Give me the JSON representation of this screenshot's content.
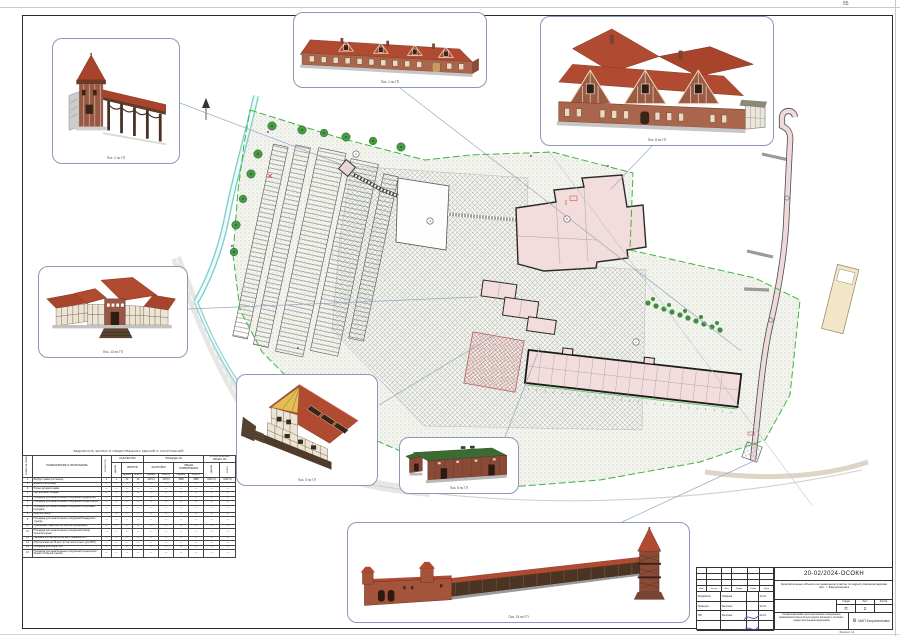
{
  "page": {
    "number": "55",
    "format_note": "Формат А1"
  },
  "colors": {
    "roof_red": "#b04a30",
    "brick": "#a9664d",
    "green_roof": "#3c6a33",
    "stream": "#7fcfcf",
    "boundary_green": "#3db53d",
    "plan_fill_pink": "#f2dcdc",
    "callout_border": "#8a9ab5",
    "signature_blue": "#2b47c4"
  },
  "callouts": [
    {
      "id": "pos2",
      "caption": "Поз. 2 по ГП"
    },
    {
      "id": "pos1",
      "caption": "Поз. 1 по ГП"
    },
    {
      "id": "pos8",
      "caption": "Поз. 8 по ГП"
    },
    {
      "id": "pos13",
      "caption": "Поз. 13 по ГП"
    },
    {
      "id": "pos5",
      "caption": "Поз. 5 по ГП"
    },
    {
      "id": "pos6",
      "caption": "Поз. 6 по ГП"
    },
    {
      "id": "pos15",
      "caption": "Поз. 15 по ГП"
    }
  ],
  "plan_labels": [
    {
      "num": "2"
    },
    {
      "num": "4"
    },
    {
      "num": "8"
    },
    {
      "num": "1"
    }
  ],
  "vedomost": {
    "title": "ВЕДОМОСТЬ ЖИЛЫХ И ОБЩЕСТВЕННЫХ ЗДАНИЙ И СООРУЖЕНИЙ",
    "headers": {
      "col_num": "НОМЕР НА ПЛАНЕ",
      "col_name": "НАИМЕНОВАНИЕ И ОБОЗНАЧЕНИЕ",
      "col_floors": "ЭТАЖНОСТЬ",
      "grp_qty": "КОЛИЧЕСТВО",
      "col_bld": "ЗДАНИЙ",
      "grp_apt": "КВАРТИР",
      "sub_sd": "СДАЕМ",
      "sub_vs": "ВСЕГО",
      "grp_area": "ПЛОЩАДЬ, М2",
      "grp_zastr": "ЗАСТРОЙКИ",
      "grp_obsh": "ОБЩАЯ НОРМИРУЕМАЯ",
      "grp_vol": "СТРОИТЕЛЬНЫЙ ОБЪЕМ, М3",
      "col_vol_bld": "ЗДАНИЙ",
      "col_vol_total": "ВСЕГО"
    },
    "rows": [
      {
        "n": "1",
        "name": "Форбург замка (гостиница)",
        "v": [
          "4",
          "1",
          "42",
          "42",
          "1270,0",
          "1270,0",
          "3985",
          "3985",
          "16017,0",
          "16017,0"
        ]
      },
      {
        "n": "2",
        "name": "Донжон (смотровая)",
        "v": [
          "—",
          "—",
          "—",
          "—",
          "—",
          "—",
          "—",
          "—",
          "—",
          "—"
        ]
      },
      {
        "n": "3",
        "name": "Руины цитадели замка",
        "v": [
          "—",
          "—",
          "—",
          "—",
          "—",
          "—",
          "—",
          "—",
          "—",
          "—"
        ]
      },
      {
        "n": "4",
        "name": "Прогулочная площадь",
        "v": [
          "—",
          "—",
          "—",
          "—",
          "—",
          "—",
          "—",
          "—",
          "—",
          "—"
        ]
      },
      {
        "n": "5",
        "name": "Площадка для некапитальных сооружений (фудкортов)",
        "v": [
          "—",
          "—",
          "—",
          "—",
          "—",
          "—",
          "—",
          "—",
          "—",
          "—"
        ]
      },
      {
        "n": "6",
        "name": "Площадка для некапитальных сооружений летнего музея",
        "v": [
          "—",
          "—",
          "—",
          "—",
          "—",
          "—",
          "—",
          "—",
          "—",
          "—"
        ]
      },
      {
        "n": "7",
        "name": "Площадка для некапитальных сооружений спортивных площадок",
        "v": [
          "—",
          "—",
          "—",
          "—",
          "—",
          "—",
          "—",
          "—",
          "—",
          "—"
        ]
      },
      {
        "n": "8",
        "name": "Конгресс-центр",
        "v": [
          "—",
          "—",
          "—",
          "—",
          "—",
          "—",
          "—",
          "—",
          "—",
          "—"
        ]
      },
      {
        "n": "9",
        "name": "Площадка для некапитальных сооружений Рыцарского турнира",
        "v": [
          "—",
          "—",
          "—",
          "—",
          "—",
          "—",
          "—",
          "—",
          "—",
          "—"
        ]
      },
      {
        "n": "10",
        "name": "Сувенирные лавки мастер-классов (временные)",
        "v": [
          "—",
          "—",
          "—",
          "—",
          "—",
          "—",
          "—",
          "—",
          "—",
          "—"
        ]
      },
      {
        "n": "11",
        "name": "Площадка для некапитальных сооружений (шатёр большой сцены)",
        "v": [
          "—",
          "—",
          "—",
          "—",
          "—",
          "—",
          "—",
          "—",
          "—",
          "—"
        ]
      },
      {
        "n": "12",
        "name": "Парковка для автомобилей мест хранения МГН",
        "v": [
          "—",
          "—",
          "—",
          "—",
          "—",
          "—",
          "—",
          "—",
          "—",
          "—"
        ]
      },
      {
        "n": "13",
        "name": "Обустроенная на 75 мест (в том числе 6 мест для МГН)",
        "v": [
          "—",
          "—",
          "—",
          "—",
          "—",
          "—",
          "—",
          "—",
          "—",
          "—"
        ]
      },
      {
        "n": "14",
        "name": "Площадка для сбора ТБО",
        "v": [
          "—",
          "—",
          "—",
          "—",
          "—",
          "—",
          "—",
          "—",
          "—",
          "—"
        ]
      },
      {
        "n": "15",
        "name": "Площадка для некапитальных сооружений (сцена возле башни с большой сценой)",
        "v": [
          "—",
          "—",
          "—",
          "—",
          "—",
          "—",
          "—",
          "—",
          "—",
          "—"
        ]
      }
    ]
  },
  "titleblock": {
    "doc_number": "20-02/2024-ОСОКН",
    "project_name": "Некапитальные объекты на земельном участке по адресу Калининградская обл., г. Багратионовск",
    "scheme_title": "Схема компоновки пространственных и визуальных взаимосвязей объектов культурного наследия с историко-градостроительным окружением",
    "stage_label": "Стадия",
    "sheet_label": "Лист",
    "sheets_label": "Листов",
    "stage": "П",
    "sheet": "2",
    "sheets": "",
    "cols": [
      "Изм.",
      "Кол.уч",
      "Лист",
      "№док.",
      "Подп.",
      "Дата"
    ],
    "roles": [
      {
        "role": "Разработал",
        "name": "Габараев",
        "date": "02.24"
      },
      {
        "role": "Проверил",
        "name": "Рассохин",
        "date": "02.24"
      },
      {
        "role": "ГАП",
        "name": "Рассохин",
        "date": "02.24"
      }
    ],
    "org_gear": "⚙",
    "org_name": "МАП Багратионовск"
  }
}
